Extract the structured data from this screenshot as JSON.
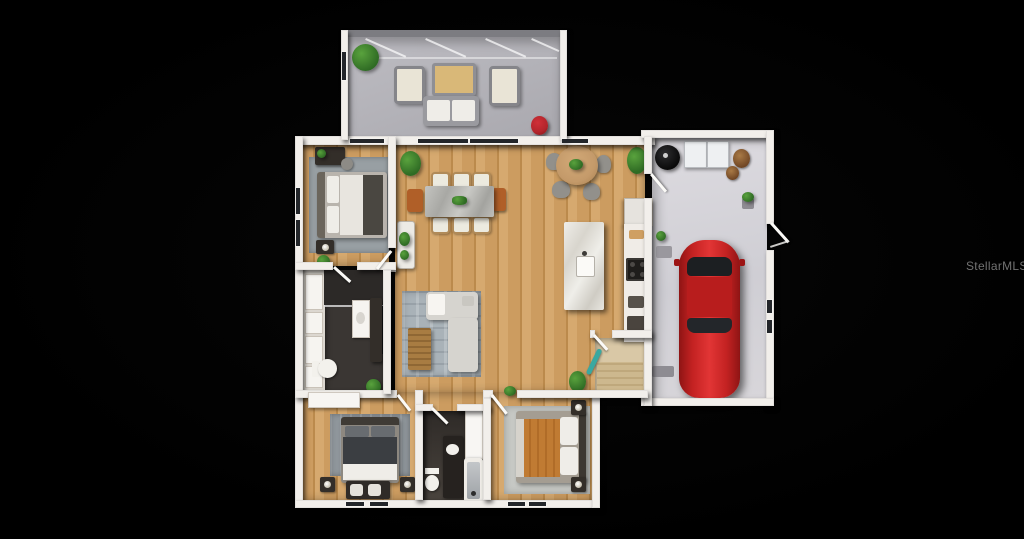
{
  "watermark": {
    "text": "StellarMLS"
  },
  "scene": {
    "type": "3d-floorplan-render-top-view",
    "background": "#000000",
    "rooms": [
      "screened-patio",
      "master-bedroom",
      "master-bathroom",
      "closet",
      "dining-area",
      "breakfast-nook",
      "kitchen",
      "living-room",
      "hallway",
      "laundry-entry",
      "bedroom-2",
      "bathroom-2",
      "bedroom-3",
      "garage"
    ],
    "objects": {
      "screened-patio": [
        "plant",
        "armchair",
        "armchair",
        "coffee-table",
        "sofa",
        "red-side-table"
      ],
      "master-bedroom": [
        "desk",
        "desk-chair",
        "rug",
        "bed",
        "nightstand",
        "plant"
      ],
      "master-bathroom": [
        "shower",
        "vanity",
        "toilet",
        "closet-shelves"
      ],
      "dining-area": [
        "plant",
        "dining-table",
        "six-white-chairs",
        "two-accent-chairs",
        "plant-stand"
      ],
      "breakfast-nook": [
        "round-table",
        "four-chairs"
      ],
      "kitchen": [
        "fridge",
        "counter",
        "stove",
        "island",
        "sink",
        "plant"
      ],
      "living-room": [
        "rug",
        "sectional-sofa",
        "coffee-table",
        "tv-console",
        "tv",
        "plants"
      ],
      "laundry-entry": [
        "ironing-board",
        "rug",
        "plant"
      ],
      "bedroom-2": [
        "credenza",
        "rug",
        "bed",
        "nightstand-lamps",
        "bench",
        "baskets"
      ],
      "bathroom-2": [
        "vanity",
        "toilet",
        "bathtub",
        "door-panel"
      ],
      "bedroom-3": [
        "rug",
        "bed",
        "nightstand-lamps"
      ],
      "garage": [
        "grill",
        "storage-cabinets",
        "baskets",
        "plant",
        "door-mats",
        "red-car",
        "side-door"
      ]
    }
  },
  "colors": {
    "wall": "#f2efeb",
    "glass": "#23262a",
    "woodA": "#cc9c60",
    "woodB": "#bb8a4c",
    "woodC": "#d6a96f",
    "patioFloor": "#b4b3b9",
    "garageFloor": "#d8d6da",
    "rugLiving": "#a9b2b8",
    "rugMaster": "#989fa3",
    "rugBed2": "#8f969b",
    "rugBed3": "#c7c9c5",
    "marble": "#e7e4df",
    "counter": "#f0ece7",
    "sofa": "#d6d4cf",
    "whiteFabric": "#efede8",
    "duvet": "#3b3e42",
    "blanketTan": "#c07b33",
    "carRed": "#c32222",
    "carRedDark": "#8e1414",
    "plantA": "#59a23d",
    "plantB": "#2f6b24",
    "darkWood": "#332e29",
    "tableWood": "#c49a6a",
    "redAccent": "#b2252b",
    "teal": "#3aa8a0",
    "bathFloor": "#3a3633",
    "entryFloor": "#d9c8a6",
    "watermark": "#8f8f8f"
  }
}
